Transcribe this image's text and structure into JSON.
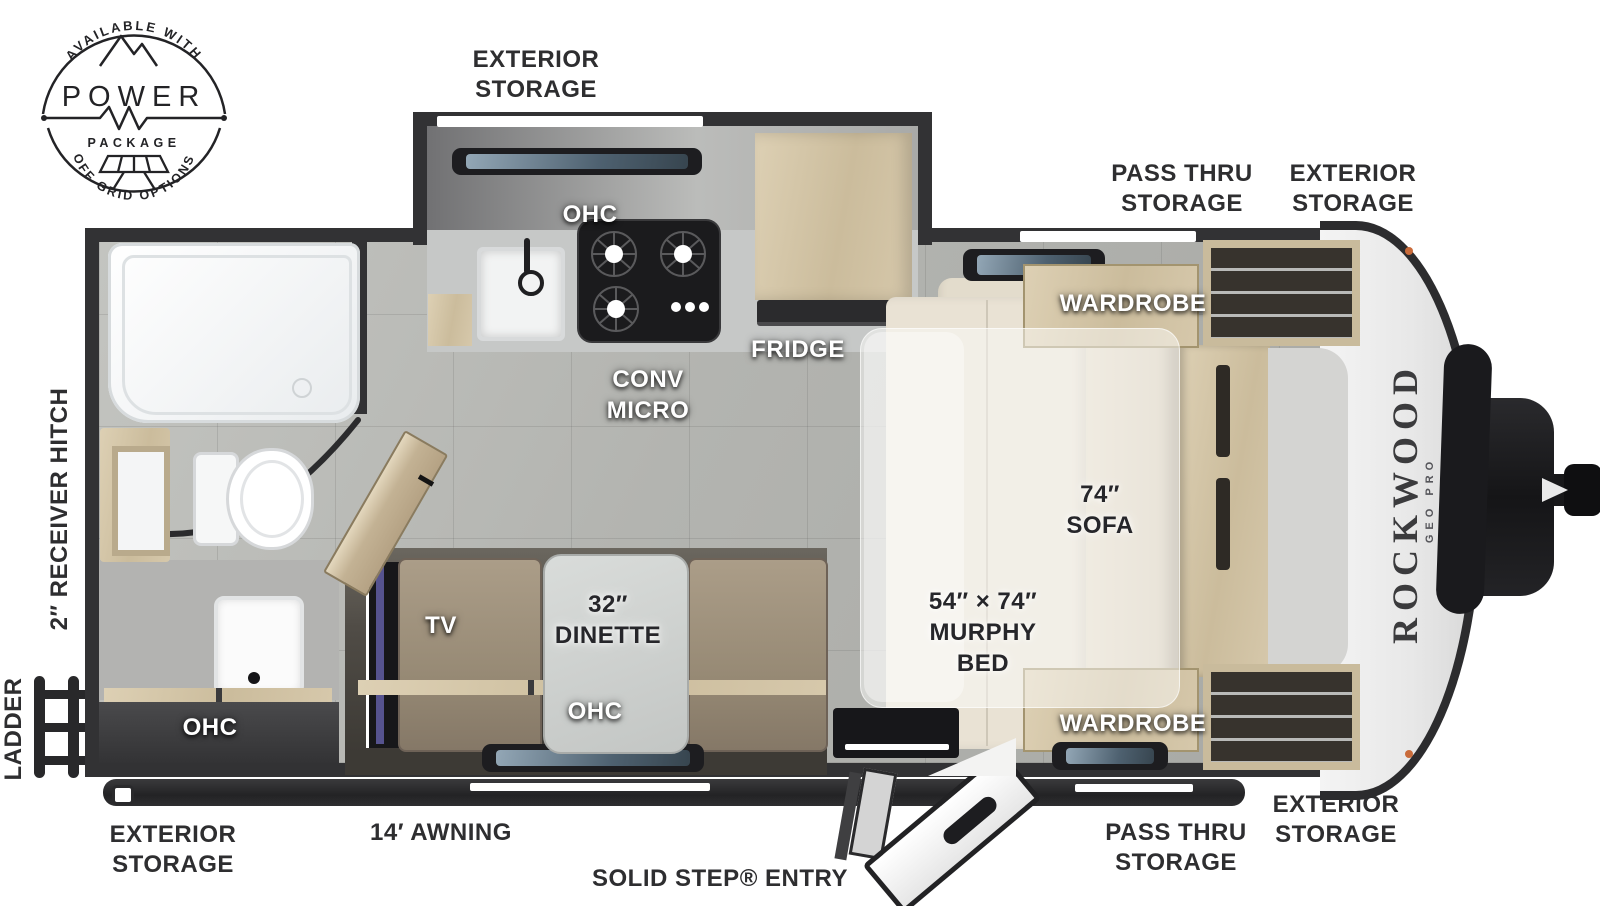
{
  "badge": {
    "arc_top": "AVAILABLE WITH",
    "word_main": "POWER",
    "word_sub": "PACKAGE",
    "arc_bottom": "OFF-GRID OPTIONS"
  },
  "brand": {
    "name": "ROCKWOOD",
    "series": "GEO PRO"
  },
  "exterior": {
    "storage_top": "EXTERIOR\nSTORAGE",
    "pass_thru_top": "PASS THRU\nSTORAGE",
    "storage_top_right": "EXTERIOR\nSTORAGE",
    "receiver_hitch": "2″ RECEIVER HITCH",
    "ladder": "LADDER",
    "storage_bottom_left": "EXTERIOR\nSTORAGE",
    "awning": "14′ AWNING",
    "entry": "SOLID STEP® ENTRY",
    "pass_thru_bottom": "PASS THRU\nSTORAGE",
    "storage_bottom_right": "EXTERIOR\nSTORAGE"
  },
  "interior": {
    "ohc_kitchen": "OHC",
    "conv_micro": "CONV\nMICRO",
    "fridge": "FRIDGE",
    "wardrobe_top": "WARDROBE",
    "sofa": "74″\nSOFA",
    "murphy_bed": "54″ × 74″\nMURPHY\nBED",
    "wardrobe_bottom": "WARDROBE",
    "tv": "TV",
    "dinette": "32″\nDINETTE",
    "ohc_dinette": "OHC",
    "ohc_bath": "OHC"
  },
  "colors": {
    "wall": "#323234",
    "floor": "#b3b4b0",
    "wood": "#d3c5a6",
    "sofa": "#e9e2d4",
    "bench": "#a49681",
    "label_dark": "#2e2e30"
  }
}
